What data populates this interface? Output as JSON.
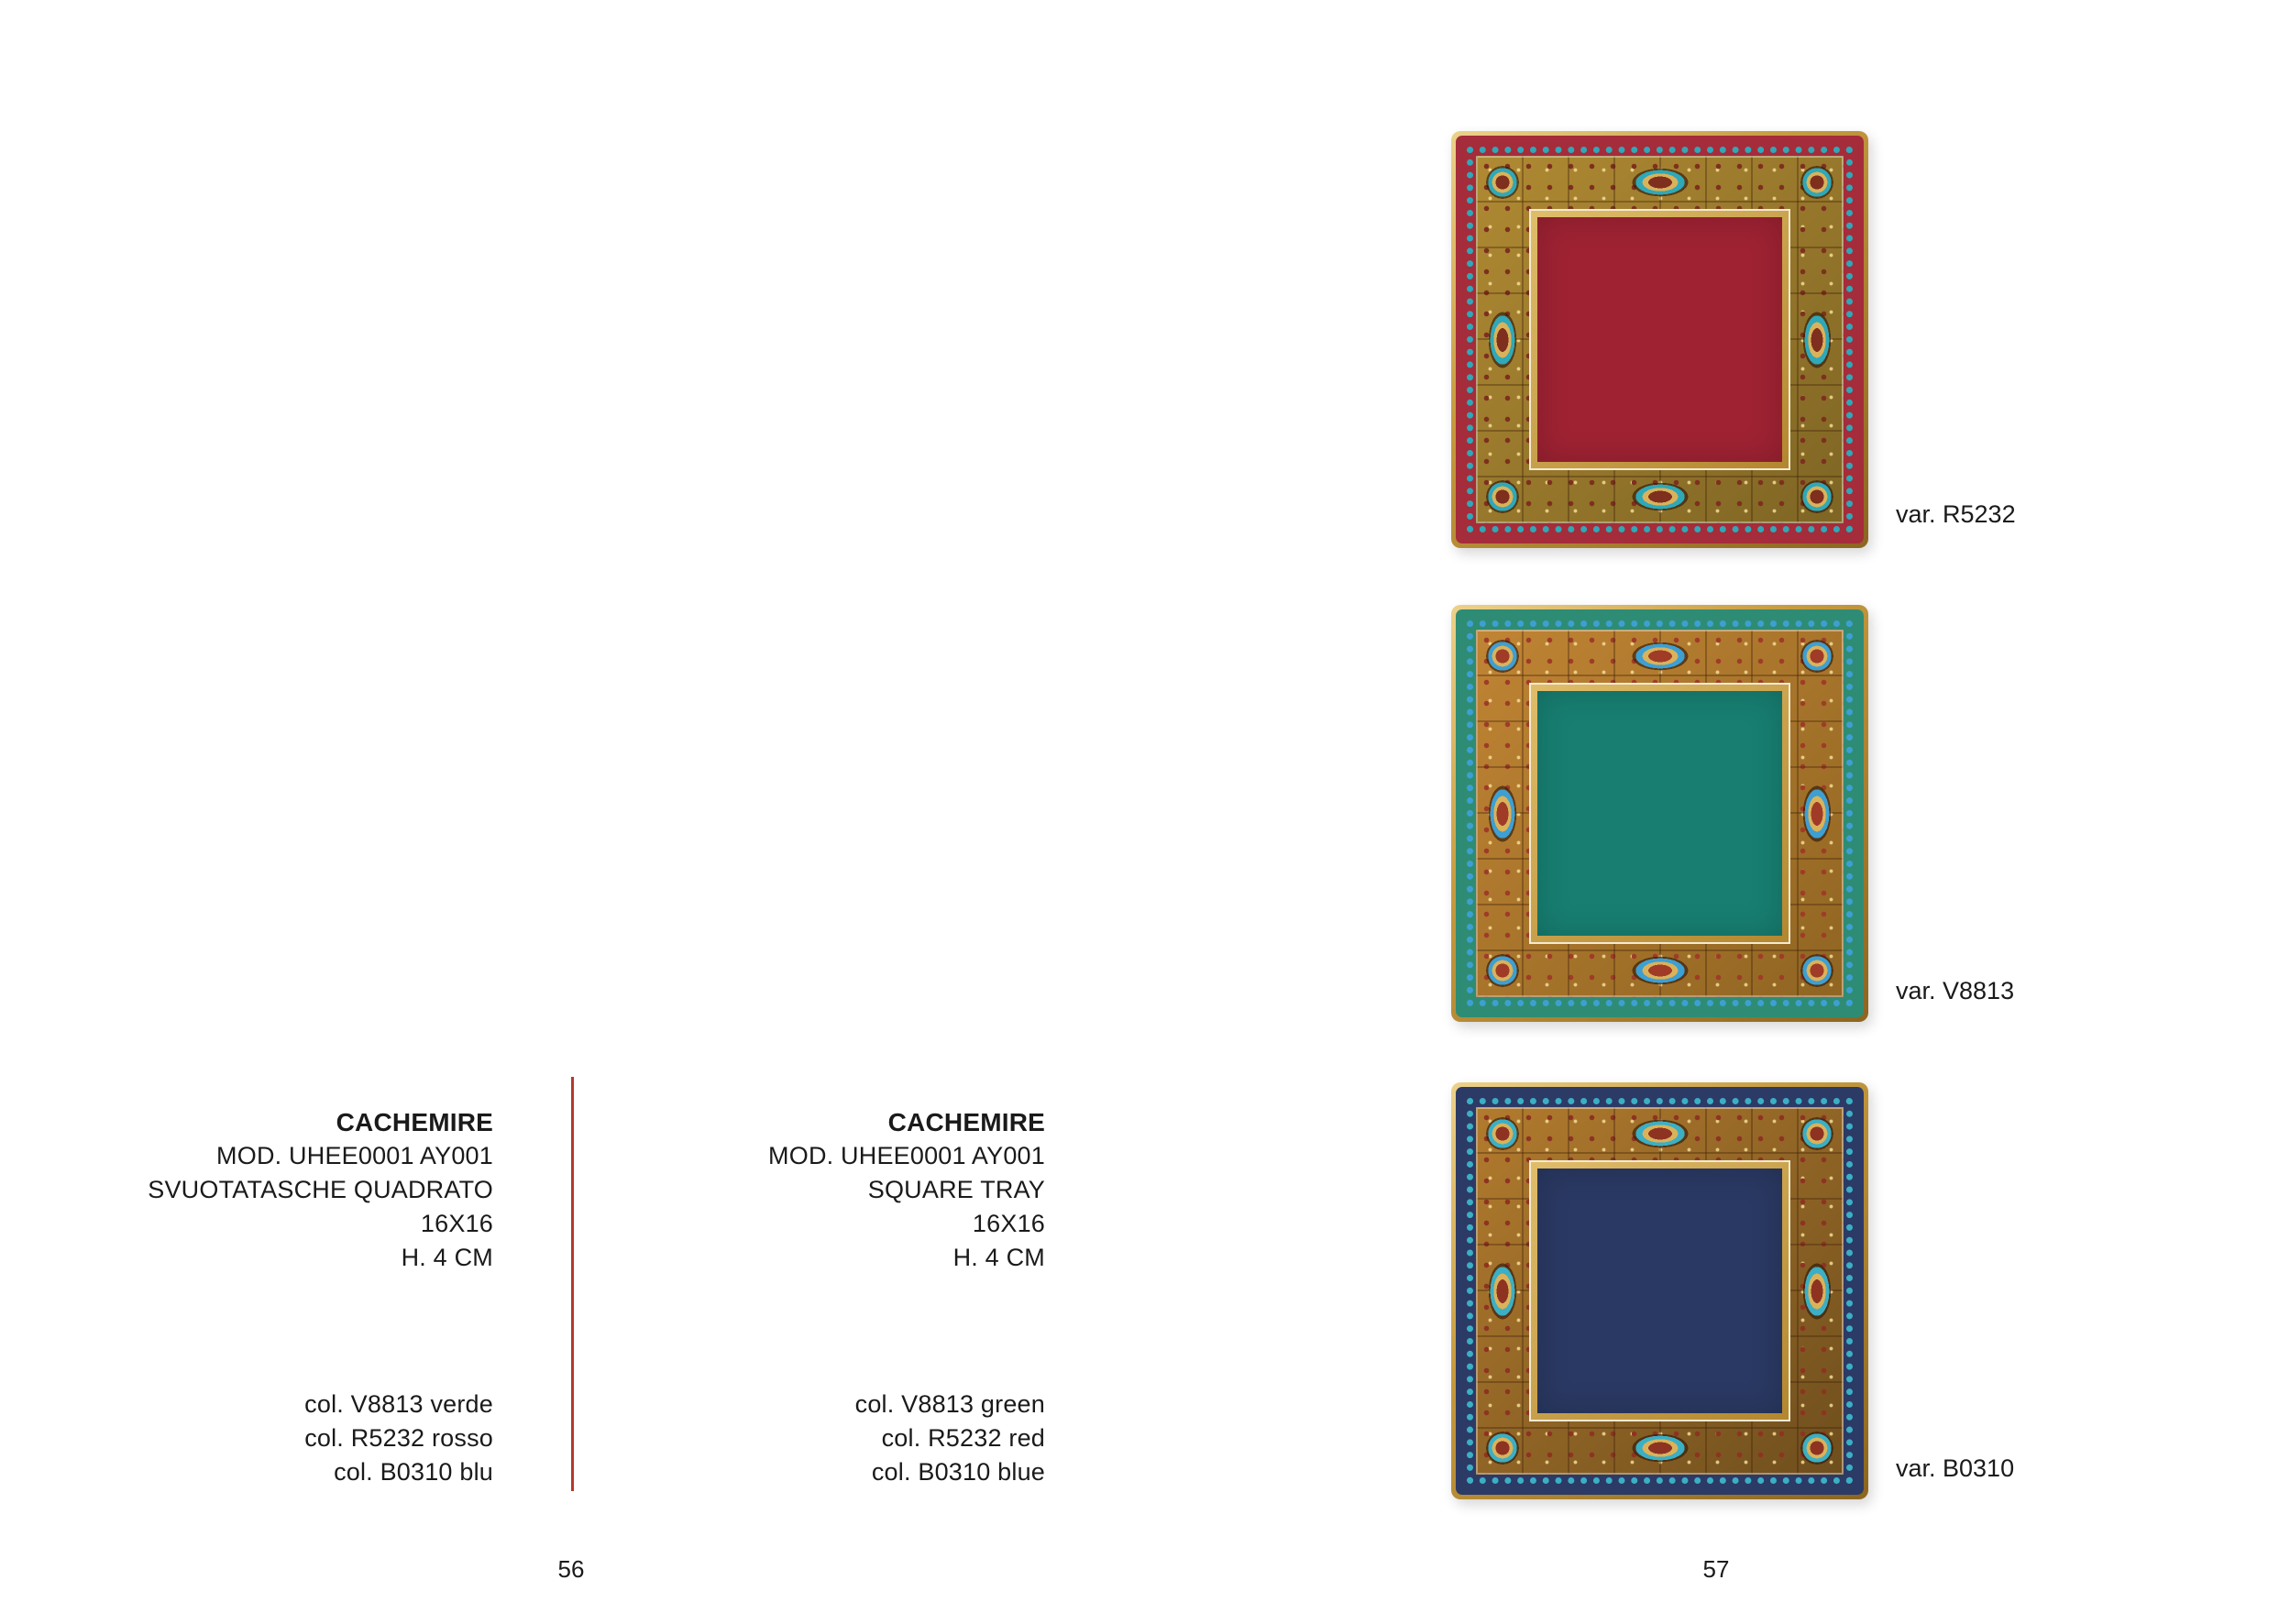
{
  "palette": {
    "text": "#1a1a1a",
    "divider": "#b5392c",
    "rim_light": "#ecd28a",
    "rim_mid": "#c69a3e",
    "rim_dark": "#8c651f",
    "frame_light": "#e0bd6a",
    "frame_dark": "#b3872f",
    "frame_edge": "#f3ead2"
  },
  "products": [
    {
      "title": "CACHEMIRE",
      "lines": [
        "MOD. UHEE0001 AY001",
        "SVUOTATASCHE QUADRATO",
        "16X16",
        "H. 4 CM"
      ],
      "colors": [
        "col. V8813 verde",
        "col. R5232 rosso",
        "col. B0310 blu"
      ]
    },
    {
      "title": "CACHEMIRE",
      "lines": [
        "MOD. UHEE0001 AY001",
        "SQUARE TRAY",
        "16X16",
        "H. 4 CM"
      ],
      "colors": [
        "col. V8813 green",
        "col. R5232 red",
        "col. B0310 blue"
      ]
    }
  ],
  "trays": [
    {
      "variant_label": "var. R5232",
      "colors": {
        "center": "#9e2232",
        "band": "#a52c3a",
        "accent": "#2fa8b8",
        "ornate_light": "#b08a33",
        "ornate_dark": "#7e6524",
        "detail": "#7e2f1e"
      }
    },
    {
      "variant_label": "var. V8813",
      "colors": {
        "center": "#177e71",
        "band": "#2e8c74",
        "accent": "#3e9fd2",
        "ornate_light": "#c08434",
        "ornate_dark": "#8f6522",
        "detail": "#a03b28"
      }
    },
    {
      "variant_label": "var. B0310",
      "colors": {
        "center": "#2a3963",
        "band": "#2c3a66",
        "accent": "#3bafc4",
        "ornate_light": "#b27b2e",
        "ornate_dark": "#6e4e1d",
        "detail": "#8e3322"
      }
    }
  ],
  "page_numbers": {
    "left": "56",
    "right": "57"
  }
}
